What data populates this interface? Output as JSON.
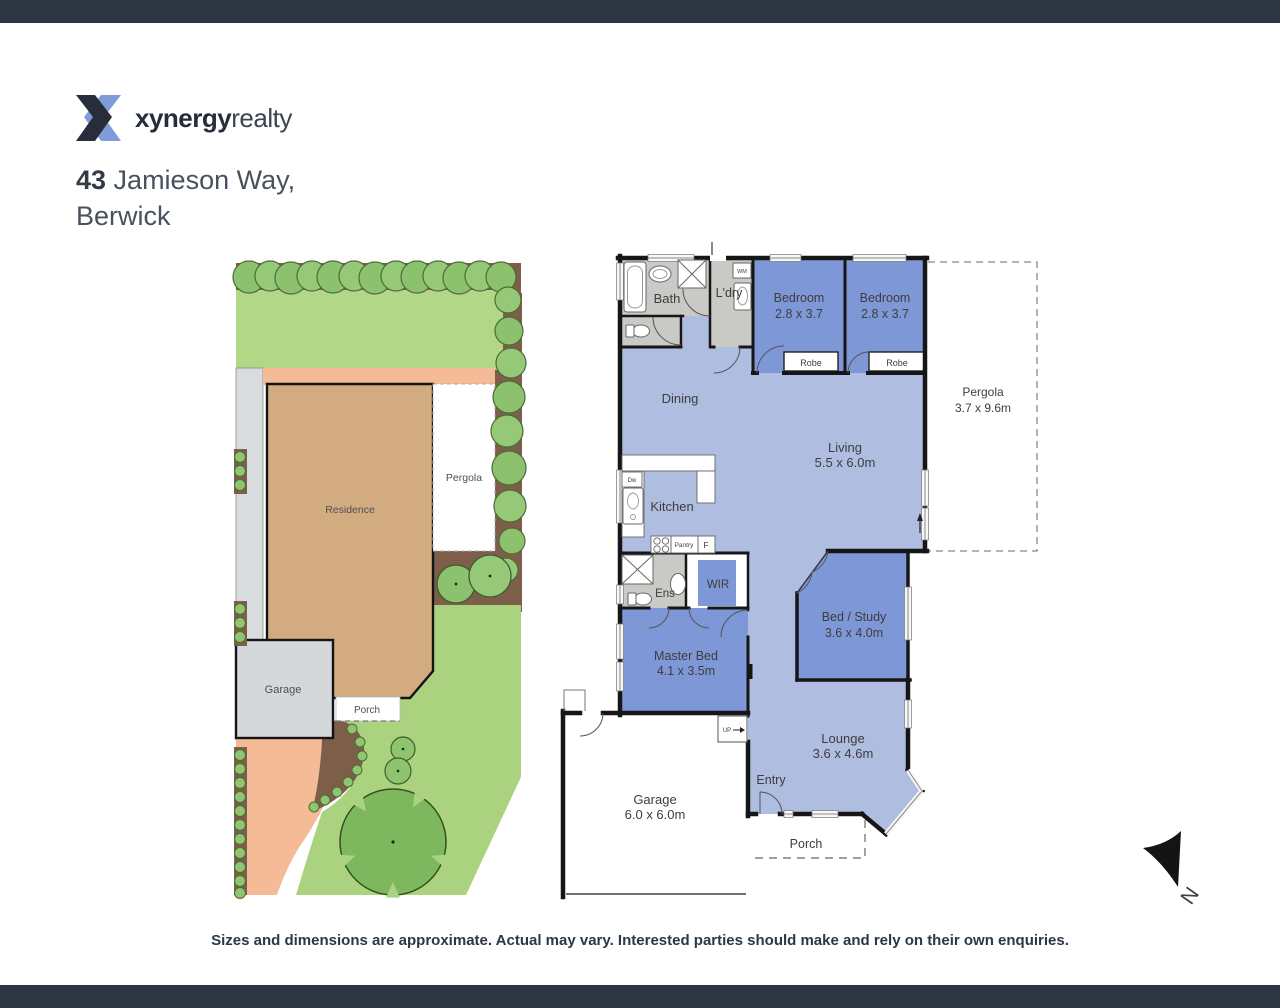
{
  "brand": {
    "name_bold": "xynergy",
    "name_light": "realty"
  },
  "address": {
    "number": "43",
    "street": " Jamieson Way,",
    "suburb": "Berwick"
  },
  "site_plan": {
    "residence": "Residence",
    "pergola": "Pergola",
    "garage": "Garage",
    "porch": "Porch"
  },
  "floor_plan": {
    "bath": "Bath",
    "laundry": "L'dry",
    "wm": "WM",
    "dw": "Dw",
    "bedroom1_name": "Bedroom",
    "bedroom1_dims": "2.8 x 3.7",
    "bedroom2_name": "Bedroom",
    "bedroom2_dims": "2.8 x 3.7",
    "robe1": "Robe",
    "robe2": "Robe",
    "pergola_name": "Pergola",
    "pergola_dims": "3.7 x 9.6m",
    "dining": "Dining",
    "living_name": "Living",
    "living_dims": "5.5 x 6.0m",
    "kitchen": "Kitchen",
    "pantry": "Pantry",
    "fridge": "F",
    "ens": "Ens",
    "wir": "WIR",
    "bed_study_name": "Bed / Study",
    "bed_study_dims": "3.6 x 4.0m",
    "master_name": "Master Bed",
    "master_dims": "4.1 x 3.5m",
    "lounge_name": "Lounge",
    "lounge_dims": "3.6 x 4.6m",
    "entry": "Entry",
    "garage_name": "Garage",
    "garage_dims": "6.0 x 6.0m",
    "porch": "Porch",
    "up": "UP"
  },
  "compass": {
    "north": "N"
  },
  "disclaimer": "Sizes and dimensions are approximate. Actual may vary. Interested parties should make and rely on their own enquiries.",
  "colors": {
    "bar": "#2d3643",
    "room_blue": "#7e97d6",
    "open_blue": "#aebde0",
    "service_gray": "#c9cac6",
    "lawn": "#b2d786",
    "tree": "#8cc26d",
    "mulch": "#7c5e49",
    "residence_tan": "#d2ab81",
    "paving_salmon": "#f5ba96",
    "driveway_gray": "#d9dcdf",
    "logo_blue": "#7e9cd9",
    "logo_dark": "#272e3a"
  }
}
